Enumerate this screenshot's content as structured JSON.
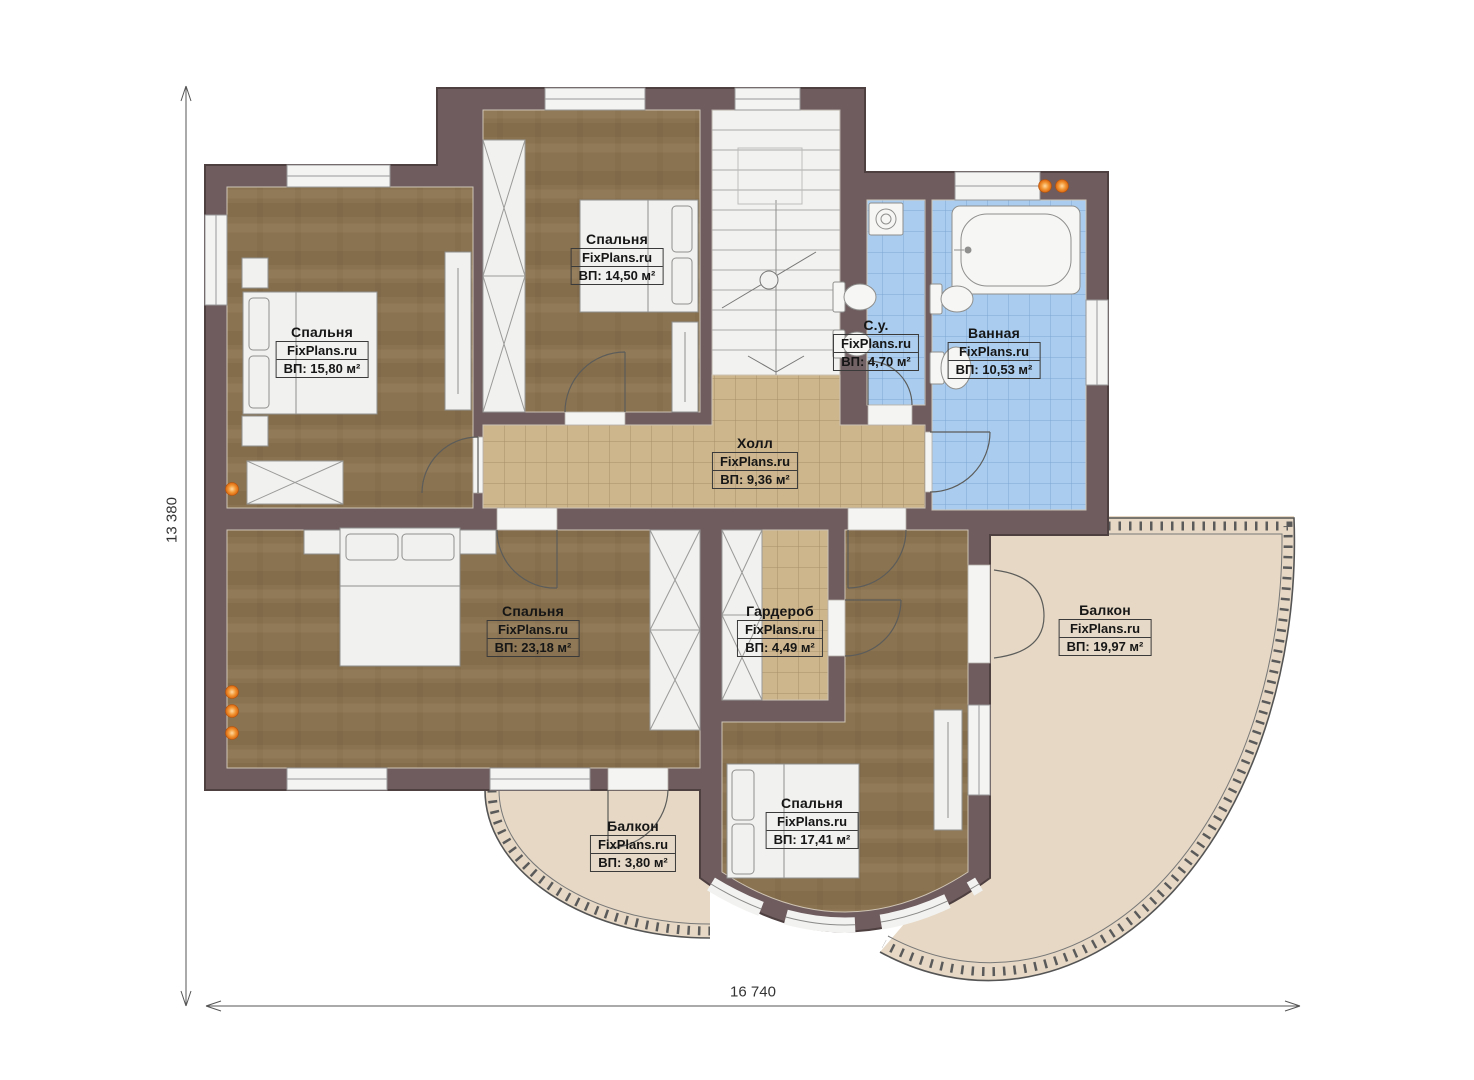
{
  "plan": {
    "brand": "FixPlans.ru",
    "dim_width": "16 740",
    "dim_height": "13 380",
    "rooms": [
      {
        "id": "bedroom-top-left",
        "name": "Спальня",
        "area": "ВП: 15,80 м²"
      },
      {
        "id": "bedroom-top-mid",
        "name": "Спальня",
        "area": "ВП: 14,50 м²"
      },
      {
        "id": "wc",
        "name": "С.у.",
        "area": "ВП: 4,70 м²"
      },
      {
        "id": "bathroom",
        "name": "Ванная",
        "area": "ВП: 10,53 м²"
      },
      {
        "id": "hall",
        "name": "Холл",
        "area": "ВП: 9,36 м²"
      },
      {
        "id": "bedroom-master",
        "name": "Спальня",
        "area": "ВП: 23,18 м²"
      },
      {
        "id": "wardrobe",
        "name": "Гардероб",
        "area": "ВП: 4,49 м²"
      },
      {
        "id": "balcony-large",
        "name": "Балкон",
        "area": "ВП: 19,97 м²"
      },
      {
        "id": "bedroom-bottom",
        "name": "Спальня",
        "area": "ВП: 17,41 м²"
      },
      {
        "id": "balcony-small",
        "name": "Балкон",
        "area": "ВП: 3,80 м²"
      }
    ],
    "colors": {
      "wall": "#6e5c5f",
      "wood_floor": "#8a7350",
      "tile_tan": "#cdb58c",
      "tile_blue": "#a9cbee",
      "balcony_floor": "#e6d8c5",
      "marker_orange": "#ee7d1e"
    }
  }
}
